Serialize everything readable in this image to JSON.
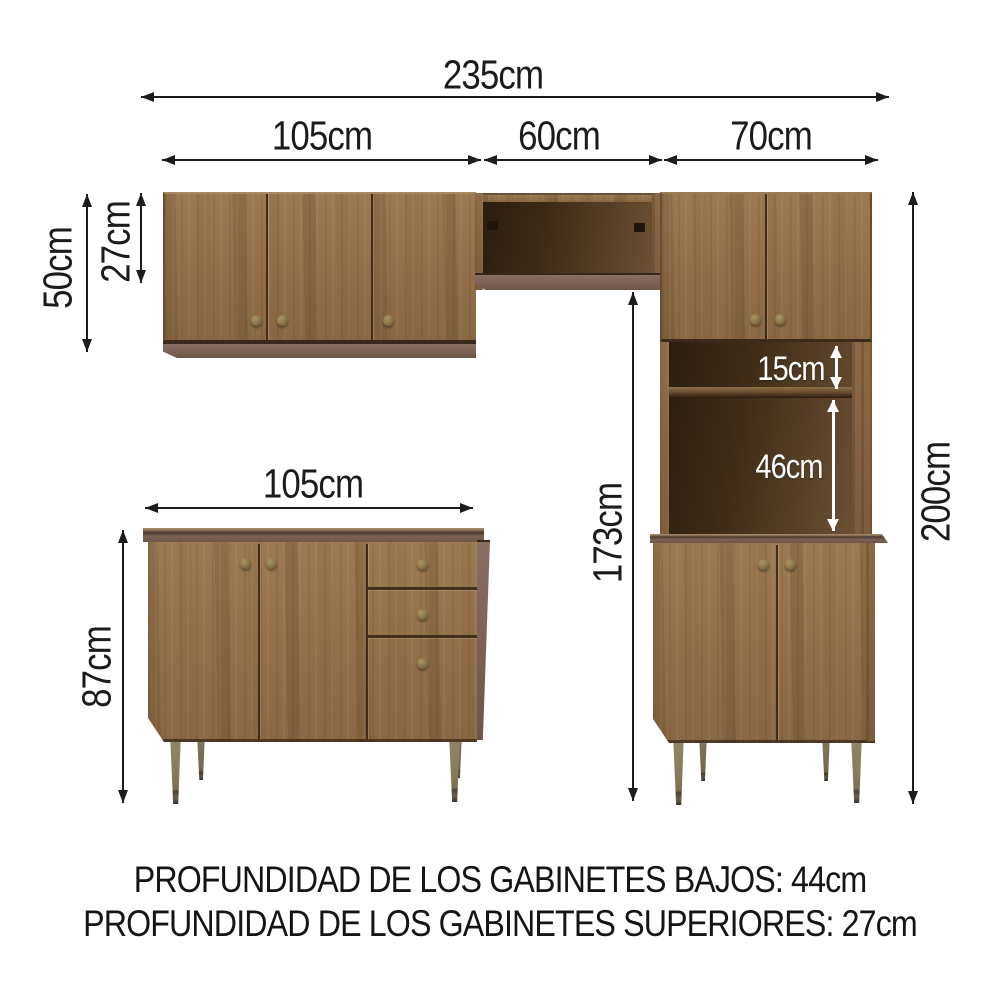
{
  "canvas": {
    "width": 1000,
    "height": 1000,
    "background": "#ffffff"
  },
  "diagram": {
    "subject": "kitchen-cabinet-set-dimension-diagram",
    "line_color": "#1c1c1c",
    "white_label_color": "#ffffff",
    "wood_color": "#92704a",
    "trim_color": "#7b6156",
    "leg_color": "#857a5c",
    "measurements": {
      "total_width": "235cm",
      "upper_left_cabinet_width": "105cm",
      "corner_shelf_width": "60cm",
      "tall_cabinet_width": "70cm",
      "upper_cabinet_height": "50cm",
      "upper_cabinet_opening_height": "27cm",
      "base_cabinet_width": "105cm",
      "base_cabinet_height": "87cm",
      "hutch_gap_small": "15cm",
      "hutch_gap_large": "46cm",
      "tall_cabinet_open_height": "173cm",
      "total_height": "200cm"
    },
    "footer": {
      "line1": "PROFUNDIDAD DE LOS GABINETES BAJOS: 44cm",
      "line2": "PROFUNDIDAD DE LOS GABINETES SUPERIORES: 27cm"
    }
  }
}
